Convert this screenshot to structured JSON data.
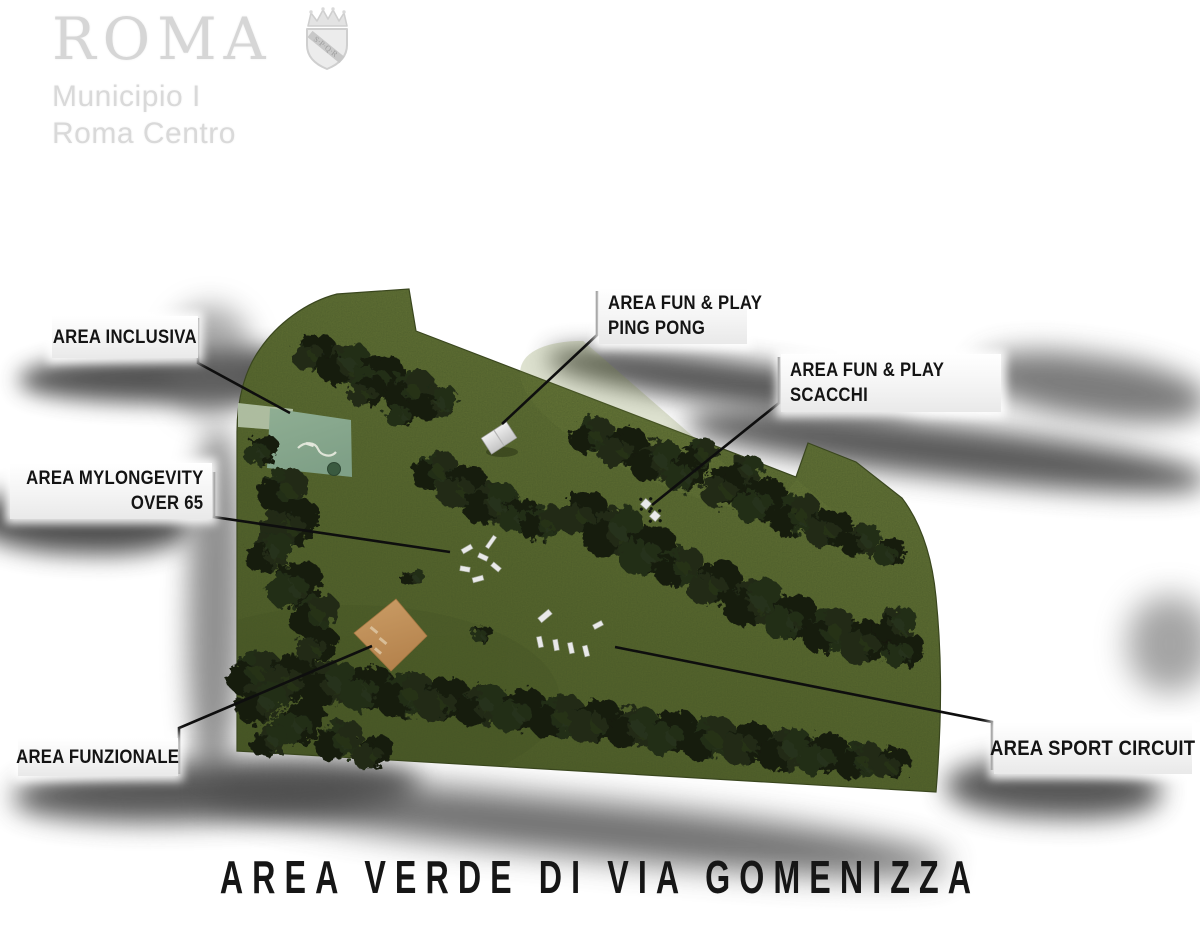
{
  "logo": {
    "city": "ROMA",
    "line1": "Municipio I",
    "line2": "Roma Centro",
    "crest": "spqr-crest"
  },
  "poster_title": "AREA VERDE DI VIA GOMENIZZA",
  "map": {
    "outline": "M 337,294 L 409,289 L 416,331 L 796,477 L 808,443 L 856,462 L 902,498 C 921,523 932,556 936,597 C 941,648 943,706 936,792 L 237,751 L 237,432 C 237,399 245,370 260,349 C 277,324 306,302 337,294 Z",
    "colors": {
      "grass_light": "#6e7d3e",
      "grass_mid": "#5a692e",
      "grass_dark": "#4e5c27",
      "edge": "#39451d",
      "tree_palette": [
        "#181f11",
        "#202a16",
        "#141a0e",
        "#232d19"
      ],
      "inclusive_area": "#8fae93",
      "inclusive_area_dark": "#7fa087",
      "inclusive_strip": "#b7c7ac",
      "functional_light": "#cb9d66",
      "functional_dark": "#b5834d",
      "leader_line": "#0e0e0e",
      "equipment_fill": "#e9e9e9",
      "equipment_stroke": "#9aa08f"
    },
    "area_labels": [
      {
        "id": "inclusiva",
        "lines": [
          "AREA INCLUSIVA"
        ],
        "box": [
          52,
          316,
          146,
          42
        ],
        "align": "center",
        "big": false,
        "leader": [
          [
            198,
            318
          ],
          [
            198,
            363
          ],
          [
            290,
            413
          ]
        ]
      },
      {
        "id": "mylongevity",
        "lines": [
          "AREA MYLONGEVITY",
          "OVER 65"
        ],
        "box": [
          10,
          463,
          202,
          56
        ],
        "align": "right",
        "big": false,
        "leader": [
          [
            214,
            472
          ],
          [
            214,
            517
          ],
          [
            450,
            552
          ]
        ]
      },
      {
        "id": "ping-pong",
        "lines": [
          "AREA FUN & PLAY",
          "PING PONG"
        ],
        "box": [
          599,
          288,
          148,
          56
        ],
        "align": "left",
        "big": false,
        "leader": [
          [
            597,
            291
          ],
          [
            597,
            335
          ],
          [
            502,
            424
          ]
        ]
      },
      {
        "id": "scacchi",
        "lines": [
          "AREA FUN & PLAY",
          "SCACCHI"
        ],
        "box": [
          781,
          354,
          220,
          58
        ],
        "align": "left",
        "big": false,
        "leader": [
          [
            779,
            357
          ],
          [
            779,
            403
          ],
          [
            652,
            505
          ]
        ]
      },
      {
        "id": "funzionale",
        "lines": [
          "AREA FUNZIONALE"
        ],
        "box": [
          18,
          738,
          160,
          38
        ],
        "align": "center",
        "big": false,
        "leader": [
          [
            179,
            774
          ],
          [
            179,
            728
          ],
          [
            372,
            646
          ]
        ]
      },
      {
        "id": "sport-circuit",
        "lines": [
          "AREA SPORT CIRCUIT"
        ],
        "box": [
          994,
          722,
          198,
          52
        ],
        "align": "center",
        "big": true,
        "leader": [
          [
            992,
            770
          ],
          [
            992,
            722
          ],
          [
            615,
            647
          ]
        ]
      }
    ],
    "trees": [
      [
        315,
        352,
        17
      ],
      [
        345,
        363,
        20
      ],
      [
        378,
        376,
        21
      ],
      [
        410,
        390,
        20
      ],
      [
        368,
        391,
        15
      ],
      [
        437,
        402,
        17
      ],
      [
        404,
        412,
        14
      ],
      [
        435,
        470,
        18
      ],
      [
        463,
        486,
        20
      ],
      [
        492,
        503,
        21
      ],
      [
        520,
        515,
        16
      ],
      [
        543,
        523,
        17
      ],
      [
        583,
        512,
        20
      ],
      [
        615,
        531,
        24
      ],
      [
        649,
        550,
        23
      ],
      [
        680,
        566,
        19
      ],
      [
        716,
        583,
        21
      ],
      [
        754,
        601,
        23
      ],
      [
        792,
        617,
        21
      ],
      [
        830,
        630,
        21
      ],
      [
        868,
        641,
        21
      ],
      [
        896,
        624,
        17
      ],
      [
        905,
        650,
        16
      ],
      [
        592,
        434,
        17
      ],
      [
        624,
        447,
        19
      ],
      [
        657,
        460,
        20
      ],
      [
        688,
        472,
        18
      ],
      [
        700,
        453,
        14
      ],
      [
        727,
        486,
        20
      ],
      [
        745,
        470,
        15
      ],
      [
        762,
        500,
        21
      ],
      [
        796,
        514,
        20
      ],
      [
        830,
        528,
        18
      ],
      [
        862,
        540,
        16
      ],
      [
        890,
        551,
        13
      ],
      [
        255,
        672,
        21
      ],
      [
        292,
        677,
        23
      ],
      [
        330,
        683,
        22
      ],
      [
        368,
        688,
        21
      ],
      [
        406,
        694,
        22
      ],
      [
        444,
        699,
        21
      ],
      [
        482,
        705,
        20
      ],
      [
        520,
        710,
        21
      ],
      [
        558,
        716,
        21
      ],
      [
        596,
        721,
        21
      ],
      [
        634,
        727,
        20
      ],
      [
        672,
        732,
        21
      ],
      [
        710,
        738,
        21
      ],
      [
        748,
        743,
        20
      ],
      [
        786,
        749,
        21
      ],
      [
        824,
        754,
        20
      ],
      [
        860,
        760,
        18
      ],
      [
        892,
        763,
        15
      ],
      [
        262,
        702,
        20
      ],
      [
        300,
        722,
        21
      ],
      [
        340,
        740,
        19
      ],
      [
        374,
        752,
        16
      ],
      [
        270,
        740,
        15
      ],
      [
        262,
        450,
        14
      ],
      [
        284,
        490,
        20
      ],
      [
        292,
        522,
        23
      ],
      [
        270,
        552,
        19
      ],
      [
        296,
        584,
        22
      ],
      [
        315,
        614,
        20
      ],
      [
        318,
        645,
        17
      ],
      [
        413,
        577,
        9
      ],
      [
        483,
        634,
        8
      ]
    ],
    "equipment": {
      "ping_pong_table": {
        "x": 499,
        "y": 438,
        "w": 30,
        "h": 19,
        "rot": -33
      },
      "chess_tables": [
        [
          646,
          504
        ],
        [
          655,
          516
        ]
      ],
      "longevity_items": [
        [
          467,
          549,
          -30,
          11,
          5
        ],
        [
          483,
          557,
          25,
          10,
          5
        ],
        [
          491,
          542,
          -55,
          14,
          4
        ],
        [
          465,
          569,
          10,
          10,
          5
        ],
        [
          496,
          567,
          40,
          10,
          5
        ],
        [
          478,
          579,
          -15,
          11,
          5
        ]
      ],
      "sport_items": [
        [
          545,
          616,
          -40,
          14,
          6
        ],
        [
          540,
          642,
          78,
          11,
          5
        ],
        [
          556,
          645,
          80,
          11,
          5
        ],
        [
          571,
          648,
          78,
          11,
          5
        ],
        [
          586,
          651,
          76,
          11,
          5
        ],
        [
          598,
          625,
          -28,
          10,
          5
        ]
      ],
      "functional_marks": [
        [
          374,
          630,
          40,
          9,
          3
        ],
        [
          383,
          641,
          40,
          9,
          3
        ],
        [
          378,
          651,
          40,
          8,
          3
        ]
      ]
    },
    "shadows": [
      [
        20,
        354,
        400,
        52,
        11,
        "#383838",
        0.85,
        -1
      ],
      [
        -25,
        486,
        215,
        64,
        12,
        "#303030",
        0.85,
        2
      ],
      [
        548,
        336,
        365,
        44,
        12,
        "#474747",
        0.9,
        7.5
      ],
      [
        688,
        396,
        520,
        52,
        13,
        "#3f3f3f",
        0.85,
        6.5
      ],
      [
        978,
        340,
        230,
        62,
        14,
        "#4f4f4f",
        0.75,
        8
      ],
      [
        1128,
        596,
        84,
        96,
        16,
        "#5a5a5a",
        0.55,
        0
      ],
      [
        946,
        756,
        215,
        58,
        13,
        "#3a3a3a",
        0.85,
        2
      ],
      [
        14,
        768,
        405,
        60,
        13,
        "#3c3c3c",
        0.85,
        -2
      ],
      [
        205,
        762,
        745,
        55,
        16,
        "#4a4a4a",
        0.8,
        5.8
      ],
      [
        188,
        428,
        54,
        348,
        13,
        "#555555",
        0.65,
        1
      ],
      [
        168,
        306,
        84,
        112,
        14,
        "#666666",
        0.55,
        0
      ]
    ]
  }
}
